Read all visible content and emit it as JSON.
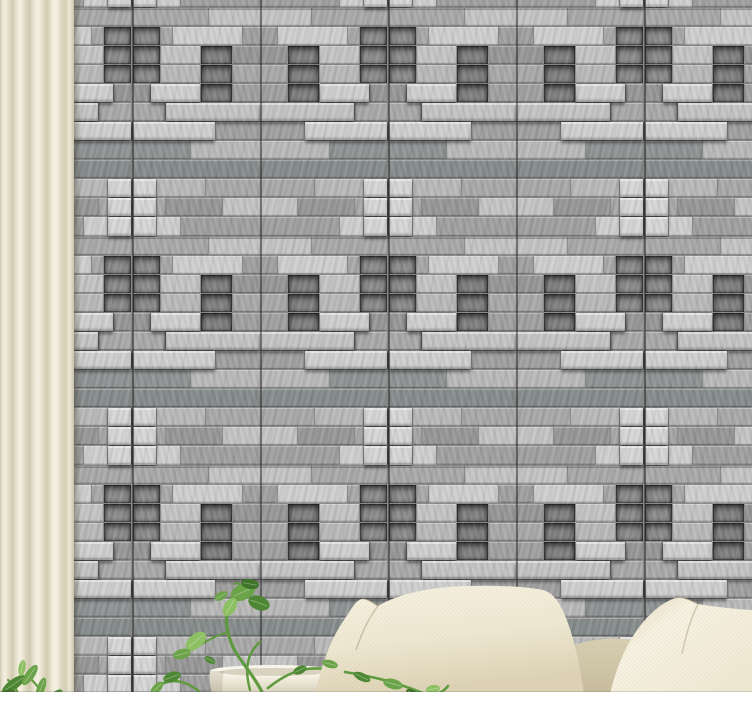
{
  "scene": {
    "description": "interior photo: grey 3D stacked-stone brick wallpaper wall with panel seam grid, cream curtain at left, trailing pothos plant in a white planter, small green plant at bottom-left corner, two cream cushions and tan sofa backrest at bottom right, white floor strip",
    "width": 752,
    "height": 703
  },
  "curtain": {
    "base_color": "#e9e4d0",
    "highlight_color": "#f5f1e2",
    "shadow_color": "#cdc6ae",
    "width": 74
  },
  "wall": {
    "left": 74,
    "width": 678,
    "height": 692,
    "mortar_color": "#8a8a8a",
    "palette": {
      "L1": "#cfcfcf",
      "L2": "#c4c4c4",
      "L3": "#b9b9b9",
      "LX": "#d6d6d6",
      "M1": "#a9a9a9",
      "M2": "#a0a0a0",
      "M3": "#979797",
      "D1": "#8f9393",
      "D2": "#868b8b",
      "DN": "#8c8c8c",
      "DN2": "#818181"
    },
    "tile": {
      "width": 128,
      "height": 229,
      "rows": [
        {
          "y": 0,
          "h": 19,
          "bricks": [
            [
              0,
              52,
              "L2"
            ],
            [
              52,
              76,
              "M1"
            ]
          ]
        },
        {
          "y": 19,
          "h": 19,
          "bricks": [
            [
              0,
              18,
              "M2"
            ],
            [
              18,
              70,
              "L1"
            ],
            [
              88,
              12,
              "M1"
            ],
            [
              100,
              28,
              "DN",
              "in"
            ]
          ]
        },
        {
          "y": 38,
          "h": 19,
          "bricks": [
            [
              0,
              28,
              "M3"
            ],
            [
              28,
              32,
              "DN2",
              "in"
            ],
            [
              60,
              40,
              "L2"
            ],
            [
              100,
              28,
              "DN",
              "in"
            ]
          ]
        },
        {
          "y": 57,
          "h": 19,
          "bricks": [
            [
              0,
              28,
              "M1"
            ],
            [
              28,
              32,
              "DN2",
              "in"
            ],
            [
              60,
              40,
              "L3"
            ],
            [
              100,
              28,
              "DN",
              "in"
            ]
          ]
        },
        {
          "y": 76,
          "h": 19,
          "bricks": [
            [
              0,
              28,
              "M2"
            ],
            [
              28,
              32,
              "DN2",
              "in"
            ],
            [
              60,
              50,
              "L1",
              "out"
            ],
            [
              110,
              18,
              "M3"
            ]
          ]
        },
        {
          "y": 95,
          "h": 19,
          "bricks": [
            [
              0,
              95,
              "L2",
              "out"
            ],
            [
              95,
              33,
              "M1"
            ]
          ]
        },
        {
          "y": 114,
          "h": 19,
          "bricks": [
            [
              0,
              45,
              "M2"
            ],
            [
              45,
              83,
              "L1",
              "out"
            ]
          ]
        },
        {
          "y": 133,
          "h": 19,
          "bricks": [
            [
              0,
              70,
              "L3"
            ],
            [
              70,
              58,
              "D1"
            ]
          ]
        },
        {
          "y": 152,
          "h": 19,
          "bricks": [
            [
              0,
              128,
              "D2"
            ]
          ]
        },
        {
          "y": 171,
          "h": 19,
          "bricks": [
            [
              0,
              55,
              "M1"
            ],
            [
              55,
              49,
              "L3"
            ],
            [
              104,
              24,
              "LX",
              "out"
            ]
          ]
        },
        {
          "y": 190,
          "h": 19,
          "bricks": [
            [
              0,
              38,
              "L2"
            ],
            [
              38,
              57,
              "M3"
            ],
            [
              95,
              9,
              "M1"
            ],
            [
              104,
              24,
              "LX",
              "out"
            ]
          ]
        },
        {
          "y": 209,
          "h": 20,
          "bricks": [
            [
              0,
              80,
              "M2"
            ],
            [
              80,
              24,
              "L1"
            ],
            [
              104,
              24,
              "LX",
              "out"
            ]
          ]
        }
      ]
    },
    "layout": {
      "col_start": -70,
      "row_start": -221,
      "cols": 6,
      "rows": 4,
      "mirror_odd_columns": true
    },
    "seams": {
      "vertical_x": [
        58,
        186,
        314,
        442,
        570
      ],
      "horizontal_y": [
        8,
        237,
        466
      ]
    }
  },
  "floor": {
    "color": "#ffffff",
    "height": 11
  },
  "pot": {
    "body_light": "#fbf9f1",
    "body_mid": "#ece6d6",
    "body_shadow": "#d4cdb8",
    "rim_light": "#f8f5ea",
    "inner_shadow": "#d8d2c0"
  },
  "backrest": {
    "light": "#d9cfb2",
    "dark": "#c8bd9e"
  },
  "pillows": {
    "light": "#f7f2e2",
    "mid": "#efe8d2",
    "shadow": "#ded3b6",
    "deep_shadow": "#d3c7a8"
  },
  "plants": {
    "leaf_dark": "#4e8733",
    "leaf_mid": "#6aa348",
    "leaf_light": "#8cc063",
    "leaf_deep": "#3f7329",
    "stem": "#5f9a3e",
    "leaves": [
      [
        14,
        684,
        14,
        5,
        -35,
        "leaf_dark"
      ],
      [
        30,
        675,
        12,
        4.5,
        -55,
        "leaf_mid"
      ],
      [
        6,
        694,
        10,
        4,
        -15,
        "leaf_deep"
      ],
      [
        41,
        688,
        11,
        4,
        -70,
        "leaf_mid"
      ],
      [
        55,
        696,
        9,
        4,
        -40,
        "leaf_dark"
      ],
      [
        22,
        668,
        8,
        3.5,
        -80,
        "leaf_light"
      ],
      [
        243,
        592,
        13,
        8,
        -25,
        "leaf_mid"
      ],
      [
        259,
        603,
        11,
        7,
        20,
        "leaf_dark"
      ],
      [
        230,
        607,
        10,
        6,
        -60,
        "leaf_light"
      ],
      [
        250,
        584,
        9,
        5,
        10,
        "leaf_deep"
      ],
      [
        221,
        596,
        7,
        4,
        -30,
        "leaf_mid"
      ],
      [
        196,
        641,
        12,
        7,
        -40,
        "leaf_light"
      ],
      [
        182,
        654,
        9,
        5,
        -15,
        "leaf_mid"
      ],
      [
        210,
        660,
        6,
        3,
        30,
        "leaf_dark"
      ],
      [
        172,
        677,
        9,
        5,
        -20,
        "leaf_dark"
      ],
      [
        157,
        688,
        8,
        4,
        -45,
        "leaf_mid"
      ],
      [
        148,
        699,
        8,
        4,
        -20,
        "leaf_deep"
      ],
      [
        300,
        670,
        7,
        4,
        -25,
        "leaf_dark"
      ]
    ],
    "front_leaves": [
      [
        330,
        664,
        8,
        4,
        15,
        "leaf_mid"
      ],
      [
        362,
        677,
        9,
        4,
        25,
        "leaf_dark"
      ],
      [
        393,
        684,
        10,
        5,
        15,
        "leaf_mid"
      ],
      [
        414,
        695,
        9,
        4,
        35,
        "leaf_deep"
      ],
      [
        433,
        689,
        7,
        4,
        -10,
        "leaf_light"
      ],
      [
        455,
        697,
        8,
        4,
        20,
        "leaf_mid"
      ]
    ]
  }
}
